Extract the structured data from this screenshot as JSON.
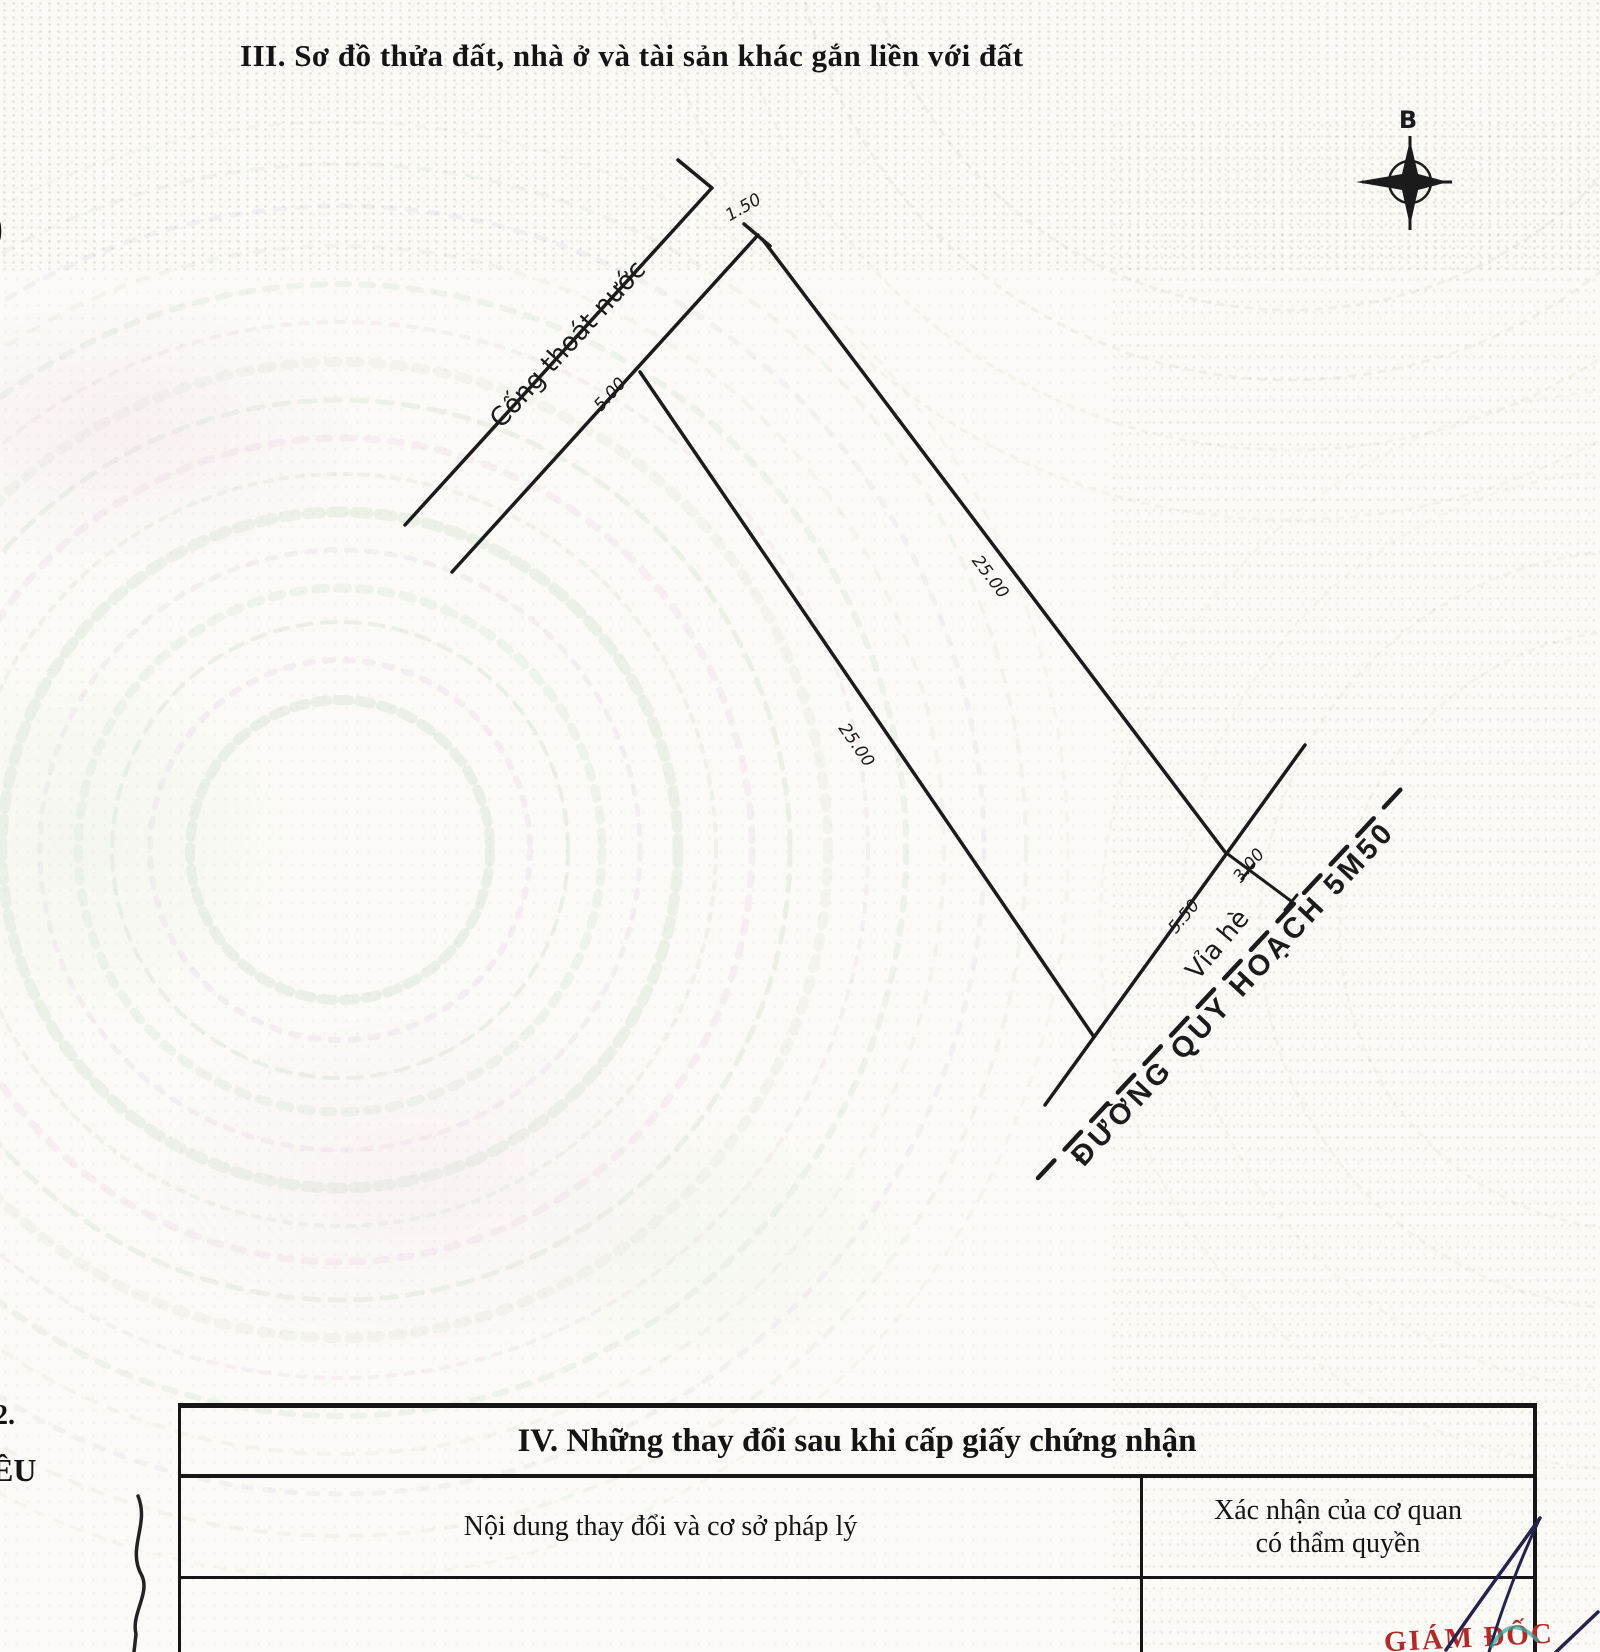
{
  "section3": {
    "title": "III. Sơ đồ thửa đất, nhà ở và tài sản khác gắn liền với đất"
  },
  "compass": {
    "north_label": "B"
  },
  "diagram": {
    "drain_label": "Cống thoát nước",
    "sidewalk_label": "Vỉa hè",
    "road_label": "ĐƯỜNG QUY HOẠCH 5M50",
    "dims": {
      "drain_width": "1.50",
      "back_width": "5.00",
      "side_a": "25.00",
      "side_b": "25.00",
      "front_width": "5.50",
      "sidewalk_width": "3.00"
    }
  },
  "section4": {
    "title": "IV. Những thay đổi sau khi cấp giấy chứng nhận",
    "col_content": "Nội dung thay đổi và cơ sở pháp lý",
    "col_confirm_line1": "Xác nhận của cơ quan",
    "col_confirm_line2": "có thẩm quyền"
  },
  "stamp": {
    "director": "GIÁM ĐỐC"
  },
  "fragments": {
    "paren": ")",
    "item_number": "2.",
    "word_part": "ỀU"
  },
  "colors": {
    "stamp_red": "#b22a28",
    "pen_ink": "#23234d",
    "teal_mark": "#2fa8a0",
    "line_ink": "#1b1b1b"
  }
}
